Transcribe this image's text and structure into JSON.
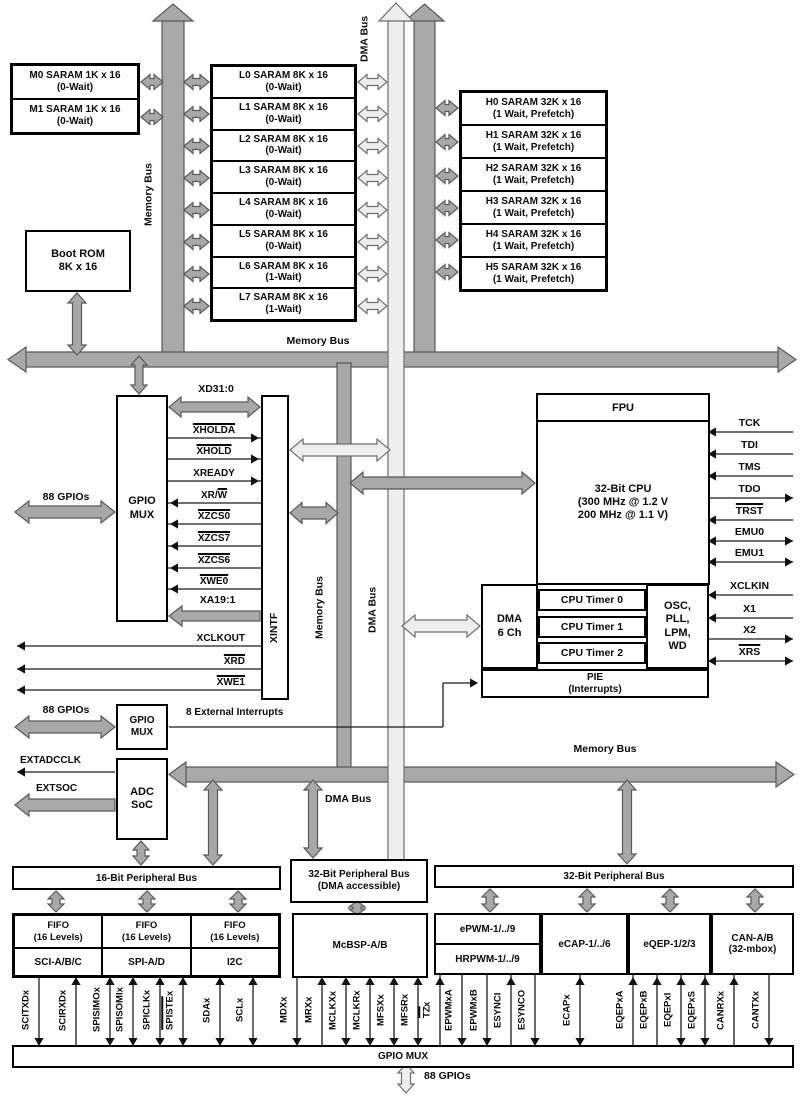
{
  "buses": {
    "memory": "Memory Bus",
    "dma": "DMA Bus",
    "p16": "16-Bit Peripheral Bus",
    "p32dma1": "32-Bit Peripheral Bus",
    "p32dma2": "(DMA accessible)",
    "p32": "32-Bit Peripheral Bus",
    "gpio_mux_bar": "GPIO MUX",
    "gpios88": "88 GPIOs"
  },
  "memory": {
    "m_blocks": [
      {
        "name": "M0 SARAM 1K x 16",
        "detail": "(0-Wait)"
      },
      {
        "name": "M1 SARAM 1K x 16",
        "detail": "(0-Wait)"
      }
    ],
    "l_blocks": [
      {
        "name": "L0 SARAM 8K x 16",
        "detail": "(0-Wait)"
      },
      {
        "name": "L1 SARAM 8K x 16",
        "detail": "(0-Wait)"
      },
      {
        "name": "L2 SARAM 8K x 16",
        "detail": "(0-Wait)"
      },
      {
        "name": "L3 SARAM 8K x 16",
        "detail": "(0-Wait)"
      },
      {
        "name": "L4 SARAM 8K x 16",
        "detail": "(0-Wait)"
      },
      {
        "name": "L5 SARAM 8K x 16",
        "detail": "(0-Wait)"
      },
      {
        "name": "L6 SARAM 8K x 16",
        "detail": "(1-Wait)"
      },
      {
        "name": "L7 SARAM 8K x 16",
        "detail": "(1-Wait)"
      }
    ],
    "h_blocks": [
      {
        "name": "H0 SARAM 32K x 16",
        "detail": "(1 Wait, Prefetch)"
      },
      {
        "name": "H1 SARAM 32K x 16",
        "detail": "(1 Wait, Prefetch)"
      },
      {
        "name": "H2 SARAM 32K x 16",
        "detail": "(1 Wait, Prefetch)"
      },
      {
        "name": "H3 SARAM 32K x 16",
        "detail": "(1 Wait, Prefetch)"
      },
      {
        "name": "H4 SARAM 32K x 16",
        "detail": "(1 Wait, Prefetch)"
      },
      {
        "name": "H5 SARAM 32K x 16",
        "detail": "(1 Wait, Prefetch)"
      }
    ],
    "boot_rom": {
      "name": "Boot ROM",
      "detail": "8K x 16"
    }
  },
  "cpu": {
    "fpu": "FPU",
    "name": "32-Bit CPU",
    "freq1": "(300 MHz @ 1.2 V",
    "freq2": "200 MHz @ 1.1 V)",
    "dma1": "DMA",
    "dma2": "6 Ch",
    "timers": [
      "CPU Timer 0",
      "CPU Timer 1",
      "CPU Timer 2"
    ],
    "osc": [
      "OSC,",
      "PLL,",
      "LPM,",
      "WD"
    ],
    "pie1": "PIE",
    "pie2": "(Interrupts)"
  },
  "xintf": {
    "label": "XINTF",
    "bus_top": "XD31:0",
    "bus_bottom": "XA19:1",
    "signals": [
      {
        "ol": "XHOLDA"
      },
      {
        "ol": "XHOLD"
      },
      {
        "pre": "XREADY"
      },
      {
        "pre": "XR/",
        "ol": "W"
      },
      {
        "ol": "XZCS0"
      },
      {
        "ol": "XZCS7"
      },
      {
        "ol": "XZCS6"
      },
      {
        "ol": "XWE0"
      }
    ],
    "out_signals": [
      {
        "pre": "XCLKOUT"
      },
      {
        "ol": "XRD"
      },
      {
        "ol": "XWE1"
      }
    ]
  },
  "left": {
    "gpio_mux1": "GPIO",
    "gpio_mux2": "MUX",
    "ext_int": "8 External Interrupts",
    "adc1": "ADC",
    "adc2": "SoC",
    "extadcclk": "EXTADCCLK",
    "extsoc": "EXTSOC"
  },
  "jtag_pins": [
    {
      "pre": "TCK"
    },
    {
      "pre": "TDI"
    },
    {
      "pre": "TMS"
    },
    {
      "pre": "TDO"
    },
    {
      "ol": "TRST"
    },
    {
      "pre": "EMU0"
    },
    {
      "pre": "EMU1"
    },
    {
      "pre": "XCLKIN"
    },
    {
      "pre": "X1"
    },
    {
      "pre": "X2"
    },
    {
      "ol": "XRS"
    }
  ],
  "peripherals": {
    "fifo_groups": [
      {
        "fifo": "FIFO",
        "levels": "(16 Levels)",
        "name": "SCI-A/B/C"
      },
      {
        "fifo": "FIFO",
        "levels": "(16 Levels)",
        "name": "SPI-A/D"
      },
      {
        "fifo": "FIFO",
        "levels": "(16 Levels)",
        "name": "I2C"
      }
    ],
    "mcbsp": "McBSP-A/B",
    "epwm": "ePWM-1/../9",
    "hrpwm": "HRPWM-1/../9",
    "ecap": "eCAP-1/../6",
    "eqep": "eQEP-1/2/3",
    "can1": "CAN-A/B",
    "can2": "(32-mbox)"
  },
  "pins_bottom": [
    {
      "pre": "SCITXDx"
    },
    {
      "pre": "SCIRXDx"
    },
    {
      "pre": "SPISIMOx"
    },
    {
      "pre": "SPISOMIx"
    },
    {
      "pre": "SPICLKx"
    },
    {
      "ol": "SPISTE",
      "post": "x"
    },
    {
      "pre": "SDAx"
    },
    {
      "pre": "SCLx"
    },
    {
      "pre": "MDXx"
    },
    {
      "pre": "MRXx"
    },
    {
      "pre": "MCLKXx"
    },
    {
      "pre": "MCLKRx"
    },
    {
      "pre": "MFSXx"
    },
    {
      "pre": "MFSRx"
    },
    {
      "ol": "TZ",
      "post": "x"
    },
    {
      "pre": "EPWMxA"
    },
    {
      "pre": "EPWMxB"
    },
    {
      "pre": "ESYNCI"
    },
    {
      "pre": "ESYNCO"
    },
    {
      "pre": "ECAPx"
    },
    {
      "pre": "EQEPxA"
    },
    {
      "pre": "EQEPxB"
    },
    {
      "pre": "EQEPxI"
    },
    {
      "pre": "EQEPxS"
    },
    {
      "pre": "CANRXx"
    },
    {
      "pre": "CANTXx"
    }
  ]
}
